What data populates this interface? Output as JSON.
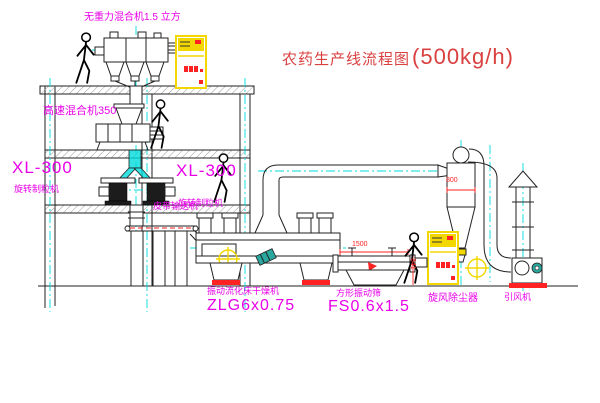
{
  "title": {
    "name": "农药生产线流程图",
    "capacity": "(500kg/h)"
  },
  "colors": {
    "magenta": "#e800e8",
    "red": "#d94040",
    "dim-red": "#ff2222",
    "cyan": "#00dcdc",
    "yellow": "#f2d800",
    "line": "#222222",
    "teal": "#2aa89e"
  },
  "equipment": {
    "gravity_mixer": {
      "label": "无重力混合机1.5 立方"
    },
    "high_speed_mixer": {
      "label": "高速混合机350"
    },
    "granulator_left": {
      "model": "XL-300",
      "name": "旋转制粒机"
    },
    "granulator_mid": {
      "model": "XL-300",
      "name": "旋转制粒机"
    },
    "belt_conveyor": {
      "label": "皮带输送机"
    },
    "fluid_bed_dryer": {
      "name": "振动流化床干燥机",
      "model": "ZLG6x0.75"
    },
    "vibrating_sieve": {
      "name": "方形振动筛",
      "model": "FS0.6x1.5"
    },
    "cyclone": {
      "name": "旋风除尘器"
    },
    "induced_draft_fan": {
      "name": "引风机"
    }
  },
  "dimensions": {
    "sieve_length": "1500",
    "sieve_height": "341",
    "cyclone_diameter": "800"
  }
}
